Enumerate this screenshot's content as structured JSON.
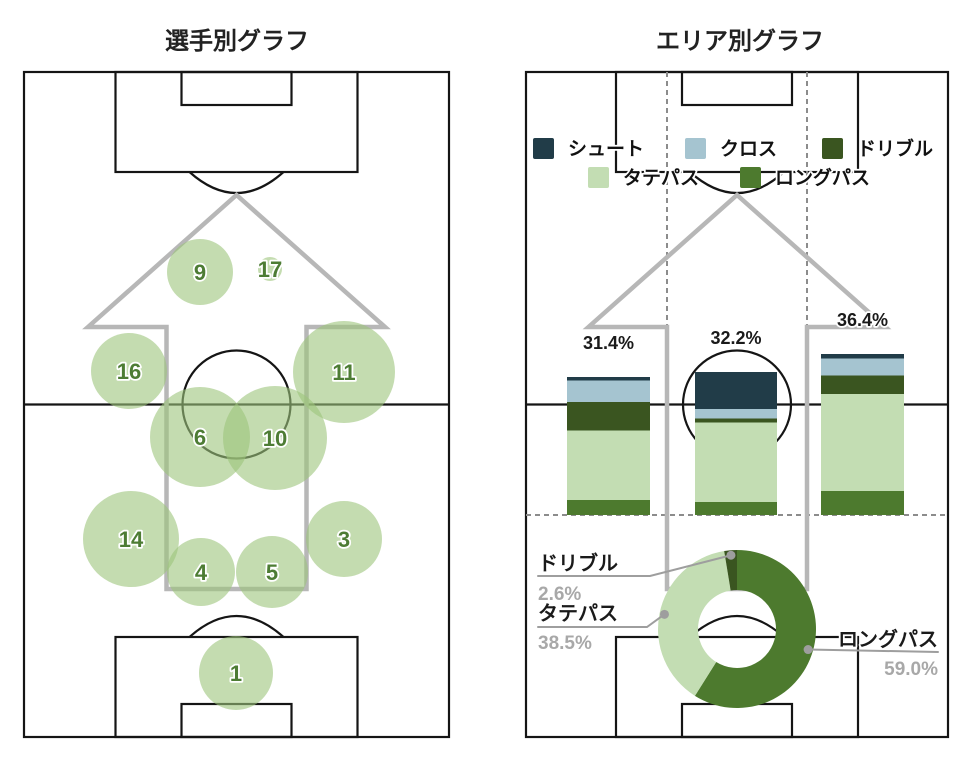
{
  "colors": {
    "shoot": "#213c48",
    "cross": "#a5c4d0",
    "dribble": "#3a5520",
    "tate": "#c3ddb3",
    "long": "#4d7a2e",
    "bubble": "rgba(157,197,123,0.6)",
    "bubble_text": "#4d7c34",
    "pitch_line": "#151515",
    "arrow": "#b7b7b7",
    "dashed": "#8c8c8c",
    "label_dark": "#1a1a1a",
    "label_gray": "#a8a8a8",
    "leader": "#9e9e9e",
    "title": "#222222"
  },
  "chart_data": [
    {
      "type": "scatter",
      "title": "選手別グラフ",
      "description": "player activity bubbles on pitch",
      "points": [
        {
          "label": "9",
          "x": 200,
          "y": 272,
          "r": 33
        },
        {
          "label": "17",
          "x": 270,
          "y": 269,
          "r": 12
        },
        {
          "label": "16",
          "x": 129,
          "y": 371,
          "r": 38
        },
        {
          "label": "11",
          "x": 344,
          "y": 372,
          "r": 51
        },
        {
          "label": "6",
          "x": 200,
          "y": 437,
          "r": 50
        },
        {
          "label": "10",
          "x": 275,
          "y": 438,
          "r": 52
        },
        {
          "label": "14",
          "x": 131,
          "y": 539,
          "r": 48
        },
        {
          "label": "3",
          "x": 344,
          "y": 539,
          "r": 38
        },
        {
          "label": "4",
          "x": 201,
          "y": 572,
          "r": 34
        },
        {
          "label": "5",
          "x": 272,
          "y": 572,
          "r": 36
        },
        {
          "label": "1",
          "x": 236,
          "y": 673,
          "r": 37
        }
      ]
    },
    {
      "type": "bar",
      "title": "エリア別グラフ",
      "stacked": true,
      "legend": [
        {
          "key": "shoot",
          "label": "シュート"
        },
        {
          "key": "cross",
          "label": "クロス"
        },
        {
          "key": "dribble",
          "label": "ドリブル"
        },
        {
          "key": "tate",
          "label": "タテパス"
        },
        {
          "key": "long",
          "label": "ロングパス"
        }
      ],
      "bars": [
        {
          "total_label": "31.4%",
          "total_pct": 31.4,
          "x": 567,
          "width": 83,
          "top": 377,
          "height": 138,
          "stack": [
            {
              "key": "shoot",
              "fraction": 0.024
            },
            {
              "key": "cross",
              "fraction": 0.157
            },
            {
              "key": "dribble",
              "fraction": 0.205
            },
            {
              "key": "tate",
              "fraction": 0.507
            },
            {
              "key": "long",
              "fraction": 0.107
            }
          ]
        },
        {
          "total_label": "32.2%",
          "total_pct": 32.2,
          "x": 695,
          "width": 82,
          "top": 372,
          "height": 143,
          "stack": [
            {
              "key": "shoot",
              "fraction": 0.259
            },
            {
              "key": "cross",
              "fraction": 0.066
            },
            {
              "key": "dribble",
              "fraction": 0.028
            },
            {
              "key": "tate",
              "fraction": 0.556
            },
            {
              "key": "long",
              "fraction": 0.091
            }
          ]
        },
        {
          "total_label": "36.4%",
          "total_pct": 36.4,
          "x": 821,
          "width": 83,
          "top": 354,
          "height": 161,
          "stack": [
            {
              "key": "shoot",
              "fraction": 0.029
            },
            {
              "key": "cross",
              "fraction": 0.105
            },
            {
              "key": "dribble",
              "fraction": 0.114
            },
            {
              "key": "tate",
              "fraction": 0.604
            },
            {
              "key": "long",
              "fraction": 0.148
            }
          ]
        }
      ]
    },
    {
      "type": "pie",
      "donut": true,
      "cx": 737,
      "cy": 629,
      "outer_r": 79,
      "inner_r": 39,
      "start": "top",
      "direction": "clockwise",
      "slices": [
        {
          "key": "long",
          "label": "ロングパス",
          "pct": 59.0,
          "pct_label": "59.0%"
        },
        {
          "key": "tate",
          "label": "タテパス",
          "pct": 38.5,
          "pct_label": "38.5%"
        },
        {
          "key": "dribble",
          "label": "ドリブル",
          "pct": 2.6,
          "pct_label": "2.6%"
        }
      ]
    }
  ]
}
